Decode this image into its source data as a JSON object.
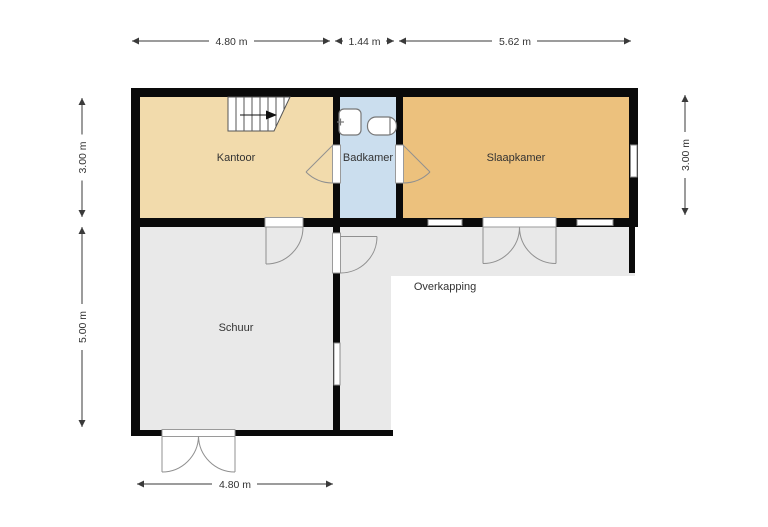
{
  "floorplan": {
    "type": "floor-plan",
    "rooms": [
      {
        "name": "Kantoor"
      },
      {
        "name": "Badkamer"
      },
      {
        "name": "Slaapkamer"
      },
      {
        "name": "Schuur"
      },
      {
        "name": "Overkapping"
      }
    ],
    "dimensions": {
      "top": [
        {
          "label": "4.80 m"
        },
        {
          "label": "1.44 m"
        },
        {
          "label": "5.62 m"
        }
      ],
      "left": [
        {
          "label": "3.00 m"
        },
        {
          "label": "5.00 m"
        }
      ],
      "right": [
        {
          "label": "3.00 m"
        }
      ],
      "bottom": [
        {
          "label": "4.80 m"
        }
      ]
    },
    "colors": {
      "kantoor": "#F2DBAC",
      "badkamer": "#CBDEEE",
      "slaapkamer": "#ECC17D",
      "schuur": "#E9E9E9",
      "overkapping": "#E9E9E9",
      "wall": "#0A0A0A"
    }
  }
}
